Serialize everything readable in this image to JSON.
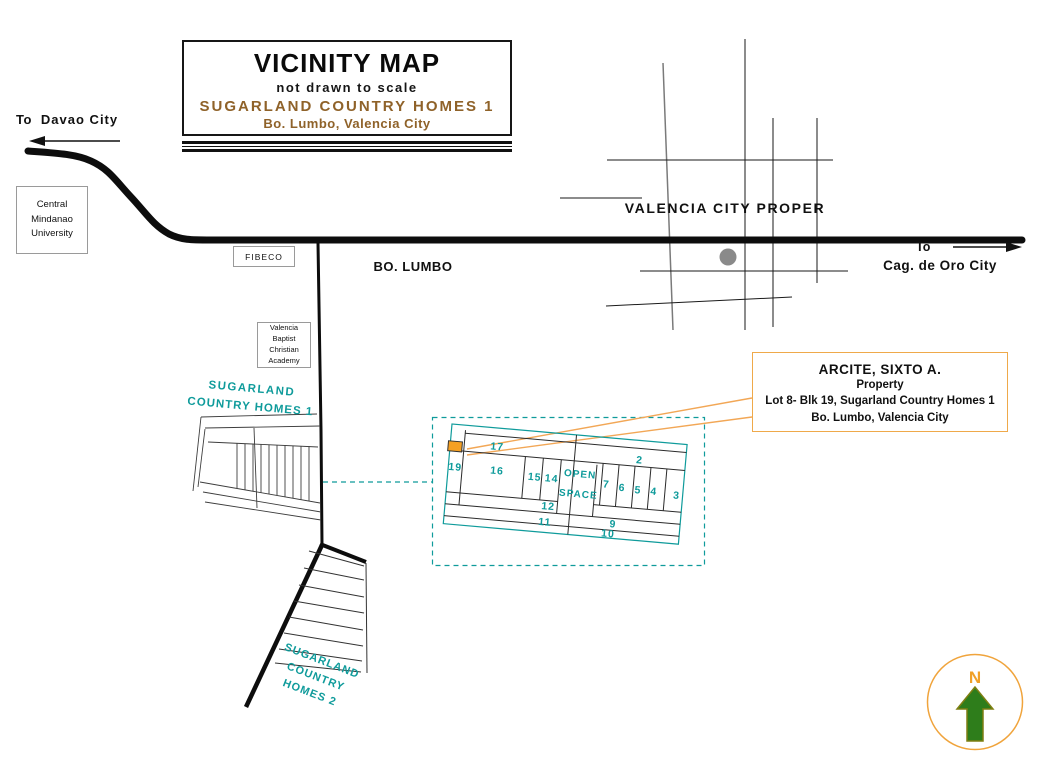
{
  "title_box": {
    "title": "VICINITY MAP",
    "subtitle": "not drawn to scale",
    "project": "SUGARLAND COUNTRY HOMES 1",
    "location": "Bo. Lumbo, Valencia City"
  },
  "roads": {
    "davao": {
      "prefix": "To",
      "destination": "Davao City"
    },
    "cagayan": {
      "prefix": "To",
      "destination": "Cag. de Oro City"
    },
    "bo_lumbo_label": "BO. LUMBO",
    "valencia_city_proper_label": "VALENCIA CITY PROPER"
  },
  "landmarks": {
    "cmu": {
      "line1": "Central",
      "line2": "Mindanao",
      "line3": "University"
    },
    "fibeco": {
      "label": "FIBECO"
    },
    "vbca": {
      "line1": "Valencia",
      "line2": "Baptist",
      "line3": "Christian",
      "line4": "Academy"
    }
  },
  "subdivision1": {
    "line1": "SUGARLAND",
    "line2": "COUNTRY HOMES 1"
  },
  "subdivision2": {
    "line1": "SUGARLAND",
    "line2": "COUNTRY",
    "line3": "HOMES 2"
  },
  "property_box": {
    "owner": "ARCITE, SIXTO A.",
    "type": "Property",
    "lot": "Lot 8- Blk 19, Sugarland Country Homes 1",
    "location": "Bo. Lumbo, Valencia City"
  },
  "detail_plan": {
    "lots": [
      "17",
      "19",
      "16",
      "15",
      "14",
      "2",
      "7",
      "6",
      "5",
      "4",
      "3",
      "12",
      "11",
      "9",
      "10"
    ],
    "open_space": {
      "line1": "OPEN",
      "line2": "SPACE"
    }
  },
  "compass": {
    "north": "N"
  },
  "colors": {
    "teal": "#0F9B9B",
    "brown": "#8F6229",
    "orange_accent": "#EFA94A",
    "orange_fill": "#F5A023",
    "arrow_green": "#2E7D1B",
    "dot_gray": "#8A8A8A"
  }
}
